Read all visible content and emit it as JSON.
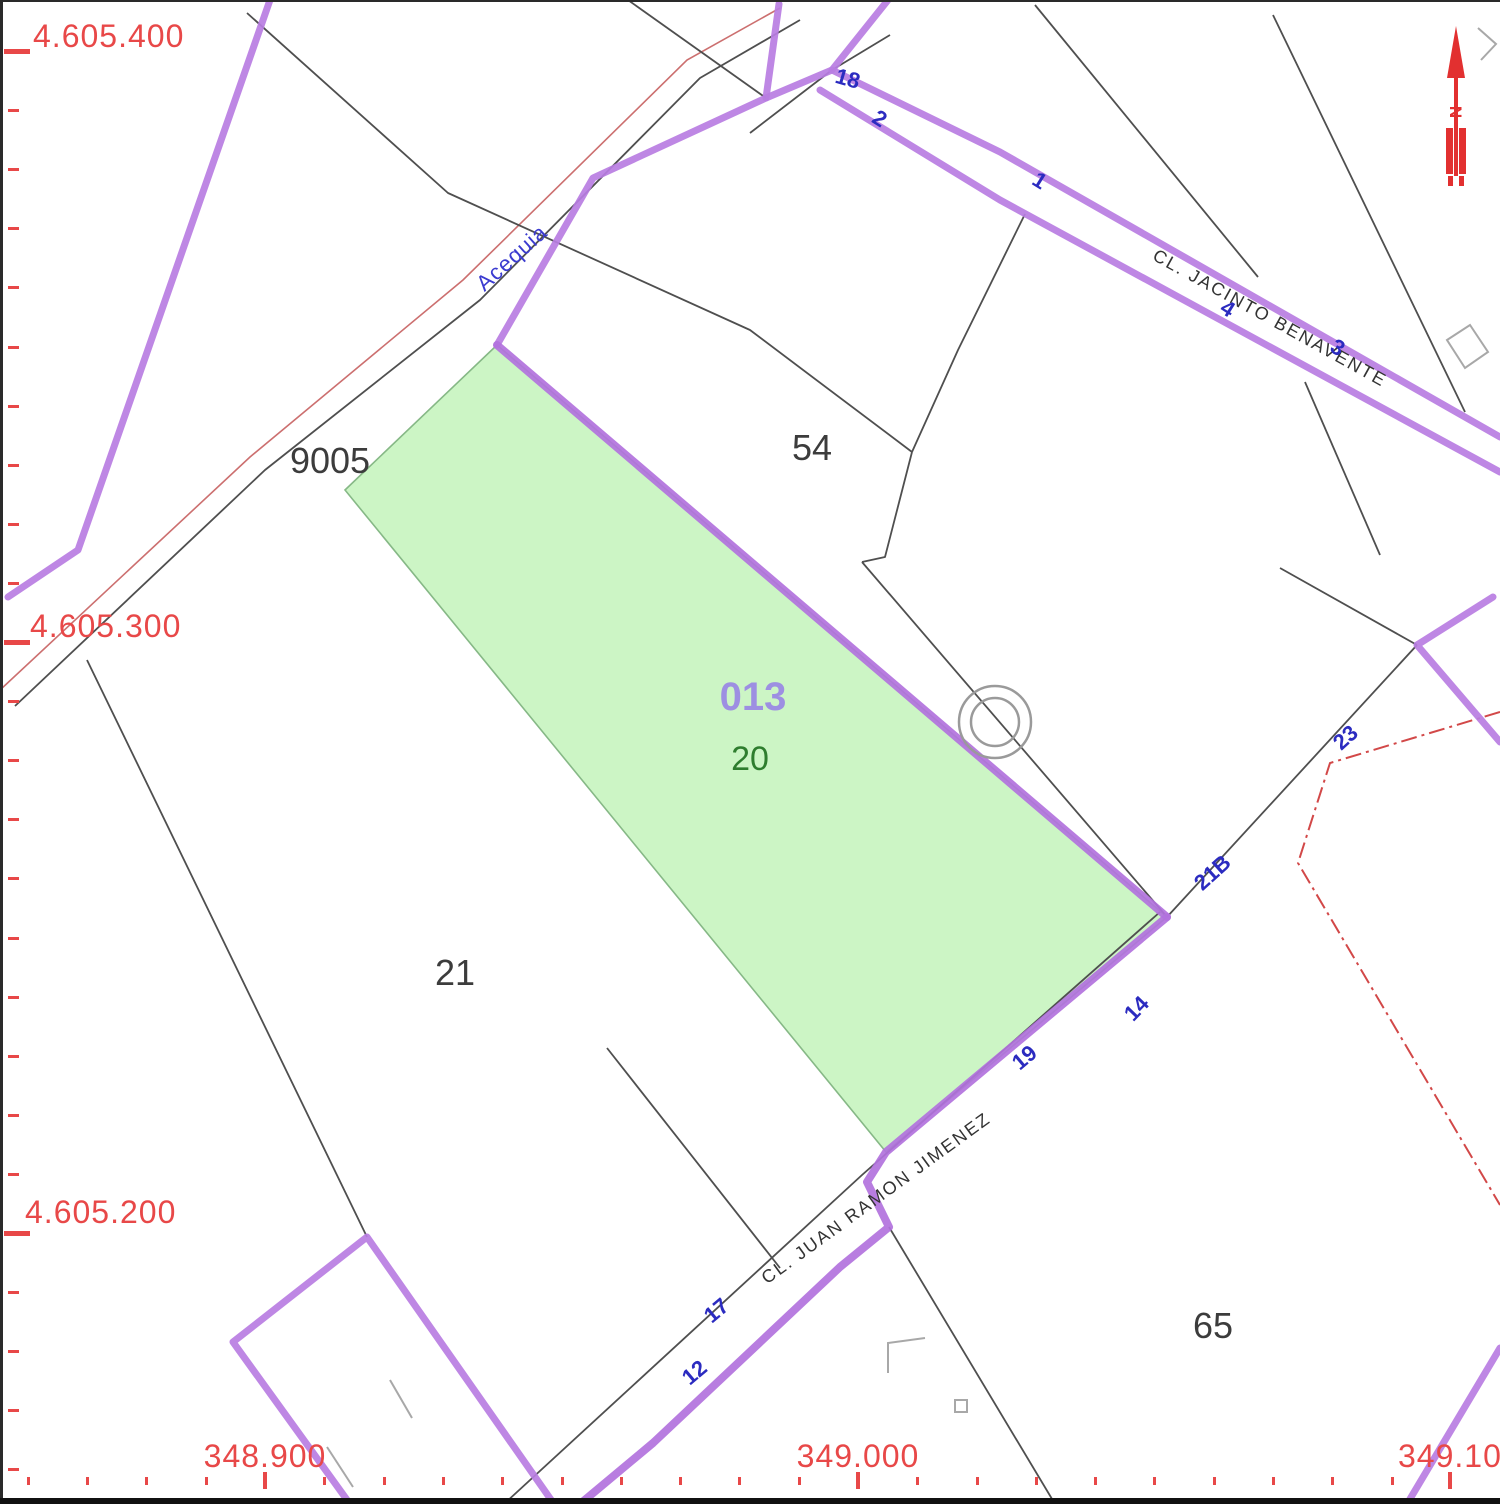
{
  "axes": {
    "y_labels": [
      "4.605.400",
      "4.605.300",
      "4.605.200"
    ],
    "x_labels": [
      "348.900",
      "349.000",
      "349.100"
    ]
  },
  "parcels": {
    "p9005": "9005",
    "p54": "54",
    "p21": "21",
    "p65": "65",
    "p20": "20",
    "selected_code": "013"
  },
  "streets": {
    "acequia": "Acequia",
    "jacinto": "CL. JACINTO BENAVENTE",
    "juan_ramon": "CL. JUAN RAMON JIMENEZ"
  },
  "numbers": {
    "n18": "18",
    "n2": "2",
    "n1": "1",
    "n4": "4",
    "n3": "3",
    "n23": "23",
    "n21b": "21B",
    "n14": "14",
    "n19": "19",
    "n17": "17",
    "n12": "12"
  },
  "north": {
    "label": "N"
  },
  "colors": {
    "selected_parcel_fill": "#ccf5c5",
    "selected_parcel_edge": "#86b886",
    "road_purple": "#b97de2",
    "boundary_black": "#4f4f4f",
    "grid_red": "#e84848",
    "municipal_boundary_red": "#d24848",
    "house_number_blue": "#2b2bc0",
    "north_arrow_red": "#e23030"
  }
}
